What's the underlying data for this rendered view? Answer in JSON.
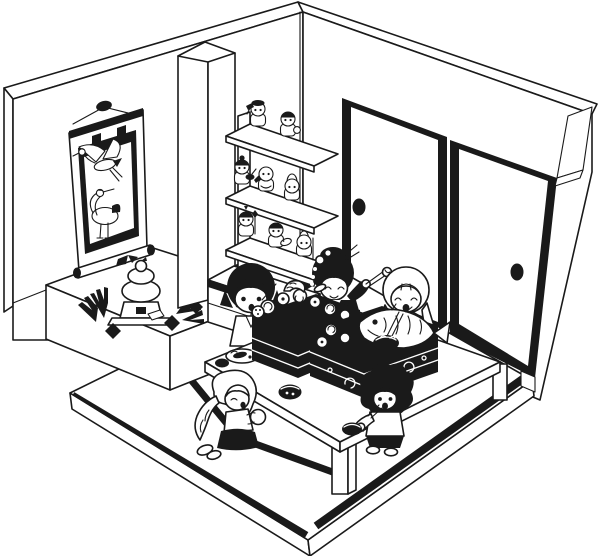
{
  "page": {
    "title": "Japanese New Year tatami room — black and white line illustration"
  },
  "palette": {
    "ink": "#1a1a1a",
    "paper": "#ffffff"
  },
  "scene": {
    "description": "Isometric cutaway of a Japanese washitsu room at New Year: a crane scroll hangs in the tokonoma alcove with kagami-mochi and pine, lucky-god figurines sit on a staggered shelf over a small chest, two fusuma sliding doors close the right wall, and five children share osechi boxes at a low table on tatami mats.",
    "counts": {
      "people": 5,
      "figurines": 9,
      "sliding_doors": 2,
      "shelves": 3,
      "osechi_boxes": 2,
      "bowls": 4
    },
    "labels": {
      "room": "washitsu room interior",
      "left_wall": "left wall",
      "right_wall": "right wall with lintel beam",
      "corner": "room corner",
      "scroll": "hanging scroll (kakejiku) with two cranes",
      "crane_flying": "flying crane",
      "crane_standing": "standing crane",
      "alcove": "tokonoma alcove platform",
      "kagami_mochi": "kagami-mochi with pine sprigs and charms",
      "pillar": "alcove pillar (tokobashira)",
      "shelf_unit": "display shelf with lucky-god figurines",
      "chest": "small chest of drawers",
      "door_left": "left fusuma sliding door",
      "door_right": "right fusuma sliding door",
      "handle": "door pull",
      "beam_end": "lintel beam end",
      "floor": "raised tatami floor with black mat borders",
      "table": "low dining table (chabudai)",
      "osechi_left": "osechi box with food",
      "osechi_right": "osechi box with sea bream",
      "sea_bream": "sea bream (tai)",
      "noodle_bowl": "noodle bowl",
      "plate": "plate with fish slices",
      "bowl": "black lacquer bowl",
      "girl_bob": "girl with black bob hair",
      "woman_kimono": "woman in patterned kimono with hair ornaments",
      "girl_pigtails": "girl with light pigtails eating noodles",
      "girl_wavy": "girl with wavy light hair holding rice cake",
      "boy_curly": "boy with curly hair holding bowl",
      "figurine": "lucky-god figurine"
    }
  }
}
